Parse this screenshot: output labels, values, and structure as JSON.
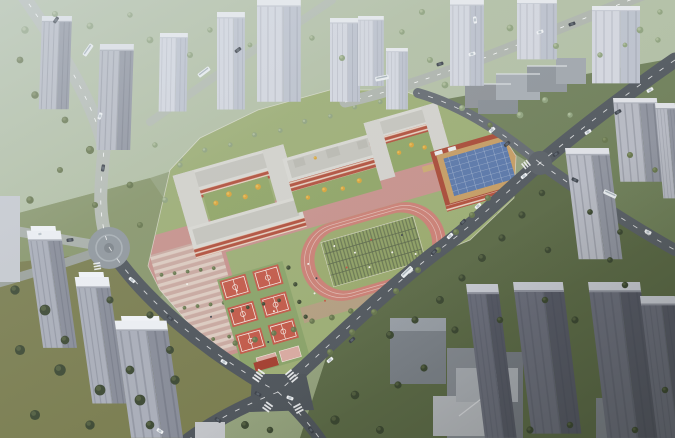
{
  "scene": {
    "type": "aerial architectural rendering",
    "subject": "new school campus with running track, basketball courts, gymnasium and teaching buildings surrounded by high-rise residential towers, parkland and city roads",
    "labels": {
      "campus": "school-campus",
      "track": "running-track",
      "field": "sports-field",
      "gym": "gymnasium-with-solar-roof",
      "teaching": "teaching-buildings",
      "courts": "basketball-courts",
      "plaza": "entrance-plaza",
      "towers": "residential-towers",
      "park": "parkland",
      "roads": "city-roads",
      "roundabout": "roundabout-plaza",
      "intersection": "main-intersection"
    },
    "palette": {
      "ground": "#93a17c",
      "park_pale": "#b2bfa4",
      "grass_left": "#87956a",
      "lawn_olive": "#797c4e",
      "green_dark": "#5c6a47",
      "green_mid": "#6f7f59",
      "road_light": "#b5bbb3",
      "road_dark": "#4f555b",
      "road_mid": "#646a70",
      "campus_green": "#9cad74",
      "pavement_pink": "#c6918b",
      "track_pink": "#ca7f74",
      "field_green": "#9aa96d",
      "field_grid": "#5d694b",
      "court_red": "#c25948",
      "court_green": "#8aa268",
      "school_red": "#b14f3b",
      "window_cream": "#ecdfce",
      "school_roof": "#d8d7d1",
      "roof_panel": "#c4c3bc",
      "courtyard_green": "#8fa465",
      "tree_yellow": "#d7a238",
      "gym_red": "#a84a36",
      "gym_roof_tan": "#c59c63",
      "solar_blue": "#5a77a8",
      "tower_roof": "#dfe1e6",
      "tower_face_light": "#b6b9c2",
      "tower_face_dark": "#8f939e",
      "tower_pale": "#d3d6de",
      "tower_pale_dark": "#bcc1cc",
      "tower_dark_face": "#6b6e7b",
      "tower_dark_side": "#565965",
      "white_roof": "#eceef2",
      "box_gray": "#8d9196",
      "tree_dark": "#3c4832",
      "tree_sage": "#8ea17c",
      "tree_olive": "#66754c",
      "car_white": "#eef0f2",
      "car_dark": "#3d424a",
      "plaza_light": "#dccabf",
      "plaza_dark": "#c8a89f"
    }
  }
}
